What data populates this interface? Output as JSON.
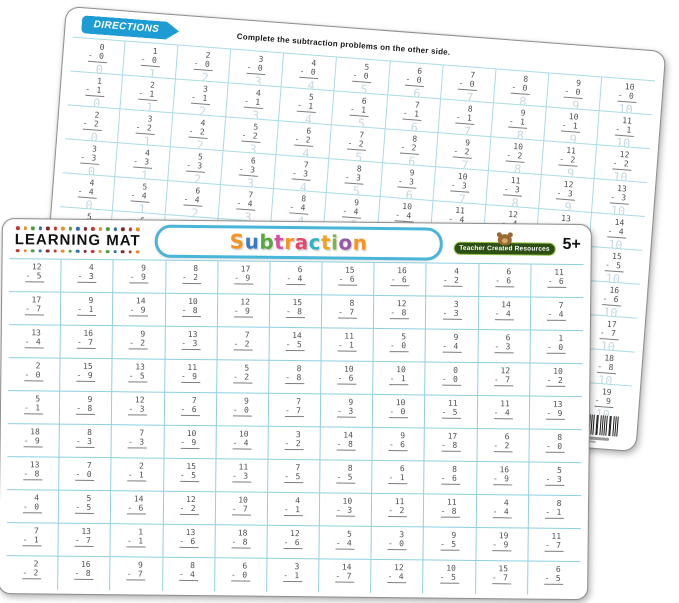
{
  "colors": {
    "banner_blue": "#1d9cd3",
    "grid_line_front": "#8ecfdf",
    "grid_line_back": "#a9dbe7",
    "problem_text": "#4f4f4f",
    "answer_text": "#c6d9e2",
    "pill_border": "#49b6d9",
    "logo_green": "#2d4e14"
  },
  "back_mat": {
    "directions_label": "DIRECTIONS",
    "directions_text": "Complete the subtraction problems on the other side.",
    "rows": [
      [
        "0-0=0",
        "1-0=1",
        "2-0=2",
        "3-0=3",
        "4-0=4",
        "5-0=5",
        "6-0=6",
        "7-0=7",
        "8-0=8",
        "9-0=9",
        "10-0=10"
      ],
      [
        "1-1=0",
        "2-1=1",
        "3-1=2",
        "4-1=3",
        "5-1=4",
        "6-1=5",
        "7-1=6",
        "8-1=7",
        "9-1=8",
        "10-1=9",
        "11-1=10"
      ],
      [
        "2-2=0",
        "3-2=1",
        "4-2=2",
        "5-2=3",
        "6-2=4",
        "7-2=5",
        "8-2=6",
        "9-2=7",
        "10-2=8",
        "11-2=9",
        "12-2=10"
      ],
      [
        "3-3=0",
        "4-3=1",
        "5-3=2",
        "6-3=3",
        "7-3=4",
        "8-3=5",
        "9-3=6",
        "10-3=7",
        "11-3=8",
        "12-3=9",
        "13-3=10"
      ],
      [
        "4-4=0",
        "5-4=1",
        "6-4=2",
        "7-4=3",
        "8-4=4",
        "9-4=5",
        "10-4=6",
        "11-4=7",
        "12-4=8",
        "13-4=9",
        "14-4=10"
      ],
      [
        "5-5=0",
        "6-5=1",
        "7-5=2",
        "8-5=3",
        "9-5=4",
        "10-5=5",
        "11-5=6",
        "12-5=7",
        "13-5=8",
        "14-5=9",
        "15-5=10"
      ],
      [
        "6-6=0",
        "7-6=1",
        "8-6=2",
        "9-6=3",
        "10-6=4",
        "11-6=5",
        "12-6=6",
        "13-6=7",
        "14-6=8",
        "15-6=9",
        "16-6=10"
      ],
      [
        "7-7=0",
        "8-7=1",
        "9-7=2",
        "10-7=3",
        "11-7=4",
        "12-7=5",
        "13-7=6",
        "14-7=7",
        "15-7=8",
        "16-7=9",
        "17-7=10"
      ],
      [
        "8-8=0",
        "9-8=1",
        "10-8=2",
        "11-8=3",
        "12-8=4",
        "13-8=5",
        "14-8=6",
        "15-8=7",
        "16-8=8",
        "17-8=9",
        "18-8=10"
      ],
      [
        "9-9=0",
        "10-9=1",
        "11-9=2",
        "12-9=3",
        "13-9=4",
        "14-9=5",
        "15-9=6",
        "16-9=7",
        "17-9=8",
        "18-9=9",
        "19-9=10"
      ]
    ]
  },
  "front_mat": {
    "brand": "LEARNING MAT",
    "title": "Subtraction",
    "title_letters": [
      {
        "ch": "S",
        "color": "#f7941d"
      },
      {
        "ch": "u",
        "color": "#3b7bbf"
      },
      {
        "ch": "b",
        "color": "#56a839"
      },
      {
        "ch": "t",
        "color": "#d94f9e"
      },
      {
        "ch": "r",
        "color": "#f7941d"
      },
      {
        "ch": "a",
        "color": "#e8476c"
      },
      {
        "ch": "c",
        "color": "#29b4c4"
      },
      {
        "ch": "t",
        "color": "#f7a11b"
      },
      {
        "ch": "i",
        "color": "#7ab648"
      },
      {
        "ch": "o",
        "color": "#9659a5"
      },
      {
        "ch": "n",
        "color": "#f7941d"
      }
    ],
    "dot_colors": [
      "#c13832",
      "#e78f27",
      "#4d9e3e",
      "#2e6fb2",
      "#7c2d2d"
    ],
    "logo_text": "Teacher Created Resources",
    "age_badge": "5+",
    "rows": [
      [
        "12-5",
        "4-3",
        "9-9",
        "8-2",
        "17-9",
        "6-4",
        "15-6",
        "16-6",
        "4-2",
        "6-6",
        "11-6"
      ],
      [
        "17-7",
        "9-1",
        "14-9",
        "10-8",
        "12-9",
        "15-8",
        "8-7",
        "12-8",
        "3-3",
        "14-4",
        "7-4"
      ],
      [
        "13-4",
        "16-7",
        "9-2",
        "13-3",
        "7-2",
        "14-5",
        "11-1",
        "5-0",
        "9-4",
        "6-3",
        "1-0"
      ],
      [
        "2-0",
        "15-9",
        "13-5",
        "11-9",
        "5-2",
        "8-8",
        "10-6",
        "10-1",
        "0-0",
        "12-7",
        "10-2"
      ],
      [
        "5-1",
        "9-8",
        "12-3",
        "7-6",
        "9-0",
        "7-7",
        "9-3",
        "10-0",
        "11-5",
        "11-4",
        "13-9"
      ],
      [
        "18-9",
        "8-3",
        "7-3",
        "10-9",
        "10-4",
        "3-2",
        "14-8",
        "9-6",
        "17-8",
        "6-2",
        "8-0"
      ],
      [
        "13-8",
        "7-0",
        "2-1",
        "15-5",
        "11-3",
        "7-5",
        "8-5",
        "6-1",
        "8-6",
        "16-9",
        "5-3"
      ],
      [
        "4-0",
        "5-5",
        "14-6",
        "12-2",
        "10-7",
        "4-1",
        "10-3",
        "11-2",
        "11-8",
        "4-4",
        "8-1"
      ],
      [
        "7-1",
        "13-7",
        "1-1",
        "13-6",
        "18-8",
        "12-6",
        "5-4",
        "3-0",
        "9-5",
        "19-9",
        "11-7"
      ],
      [
        "2-2",
        "16-8",
        "9-7",
        "8-4",
        "6-0",
        "3-1",
        "14-7",
        "12-4",
        "10-5",
        "15-7",
        "6-5"
      ]
    ]
  }
}
